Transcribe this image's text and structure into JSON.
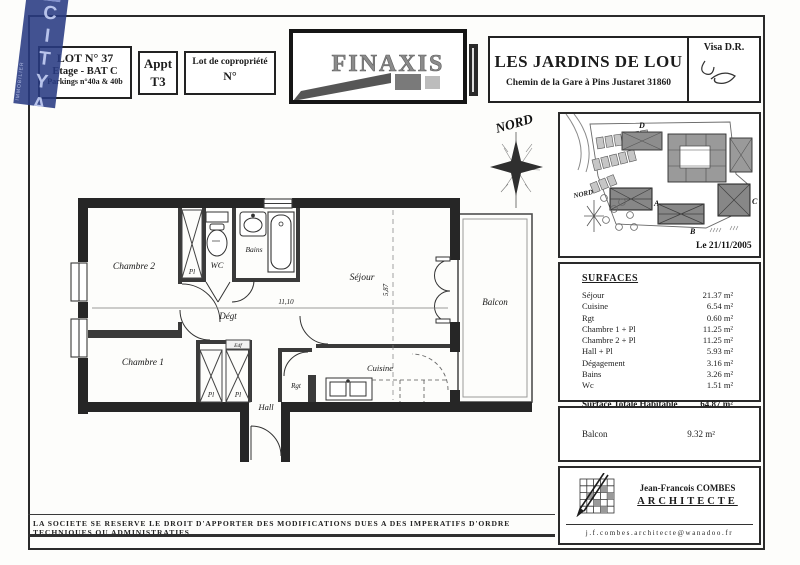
{
  "watermark": {
    "brand": "CITYA",
    "sub": "IMMOBILIER"
  },
  "header": {
    "lot": {
      "line1": "LOT N° 37",
      "line2": "Etage - BAT C",
      "line3": "Parkings n°40a & 40b"
    },
    "appt": {
      "line1": "Appt",
      "line2": "T3"
    },
    "copro": {
      "line1": "Lot de copropriété",
      "line2": "N°"
    },
    "brand": "FINAXIS",
    "title": "LES JARDINS DE LOU",
    "address": "Chemin de la Gare à Pins Justaret 31860",
    "visa": "Visa D.R."
  },
  "compass": {
    "label": "NORD"
  },
  "site_map": {
    "nord": "NORD",
    "date": "Le 21/11/2005",
    "building_a": "A",
    "building_b": "B",
    "building_c": "C",
    "building_d": "D"
  },
  "plan": {
    "rooms": {
      "chambre2": "Chambre 2",
      "pl_top": "Pl",
      "wc": "WC",
      "bains": "Bains",
      "sejour": "Séjour",
      "balcon": "Balcon",
      "degt": "Dégt",
      "chambre1": "Chambre 1",
      "pl_a": "Pl",
      "pl_b": "Pl",
      "edf": "Edf",
      "hall": "Hall",
      "rgt": "Rgt",
      "cuisine": "Cuisine"
    },
    "dims": {
      "width": "11,10",
      "height": "5,87"
    }
  },
  "surfaces": {
    "title": "SURFACES",
    "rows": [
      {
        "label": "Séjour",
        "value": "21.37 m²"
      },
      {
        "label": "Cuisine",
        "value": "6.54 m²"
      },
      {
        "label": "Rgt",
        "value": "0.60 m²"
      },
      {
        "label": "Chambre 1 + Pl",
        "value": "11.25 m²"
      },
      {
        "label": "Chambre 2 + Pl",
        "value": "11.25 m²"
      },
      {
        "label": "Hall + Pl",
        "value": "5.93 m²"
      },
      {
        "label": "Dégagement",
        "value": "3.16 m²"
      },
      {
        "label": "Bains",
        "value": "3.26 m²"
      },
      {
        "label": "Wc",
        "value": "1.51 m²"
      }
    ],
    "total": {
      "label": "Surface Totale Habitable",
      "value": "64.87 m²"
    },
    "balcon": {
      "label": "Balcon",
      "value": "9.32 m²"
    }
  },
  "architect": {
    "name": "Jean-Francois COMBES",
    "title": "ARCHITECTE",
    "email": "j.f.combes.architecte@wanadoo.fr"
  },
  "footer": {
    "disclaimer": "LA SOCIETE SE RESERVE LE DROIT D'APPORTER DES MODIFICATIONS DUES A DES IMPERATIFS D'ORDRE TECHNIQUES OU ADMINISTRATIFS"
  }
}
